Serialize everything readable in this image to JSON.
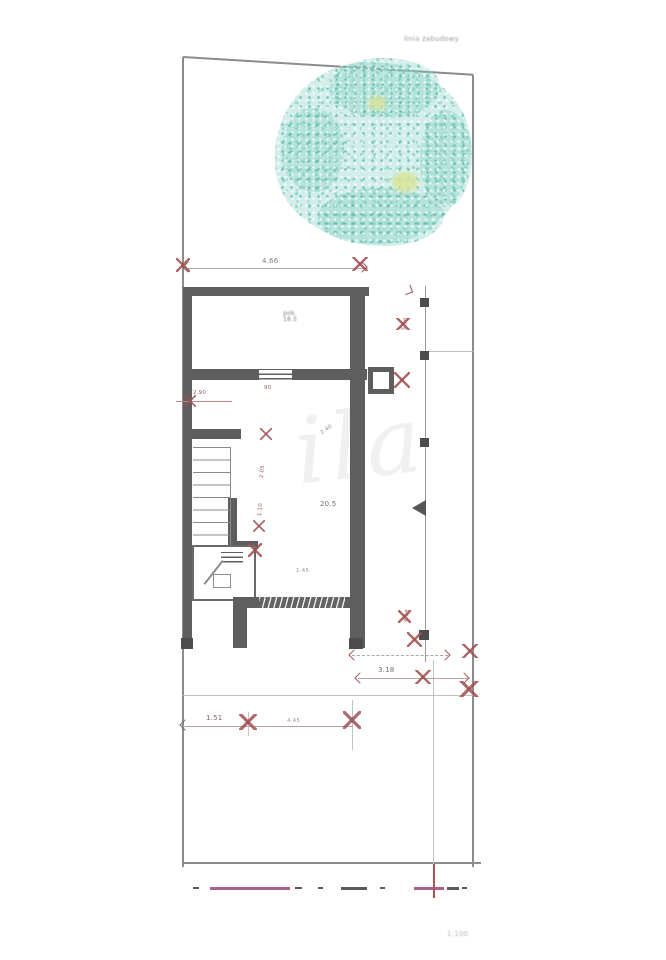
{
  "labels": {
    "boundary_note": "linia zabudowy",
    "scale_note": "1:100",
    "watermark": "ila"
  },
  "rooms": {
    "top_name": "pok.",
    "top_area": "18.5",
    "main_area": "20.5",
    "utility": "1.45"
  },
  "dims": {
    "top": "4.66",
    "left_opening": "2.90",
    "window": "90",
    "chain_a": "2.05",
    "chain_b": "1.10",
    "mid_diag": "2.40",
    "right_upper": "5.50",
    "right_lower": "4.18",
    "terrace": "3.18",
    "bottom_a": "1.51",
    "bottom_b": "4.45"
  },
  "colors": {
    "wall": "#5e5e5e",
    "boundary": "#8c8c8c",
    "dimension_red": "#a05555",
    "dimension_line": "#b5a4a4",
    "tree": "#7dccc0",
    "tree_accent": "#d8e498",
    "road_dash_pink": "#a8608c"
  }
}
